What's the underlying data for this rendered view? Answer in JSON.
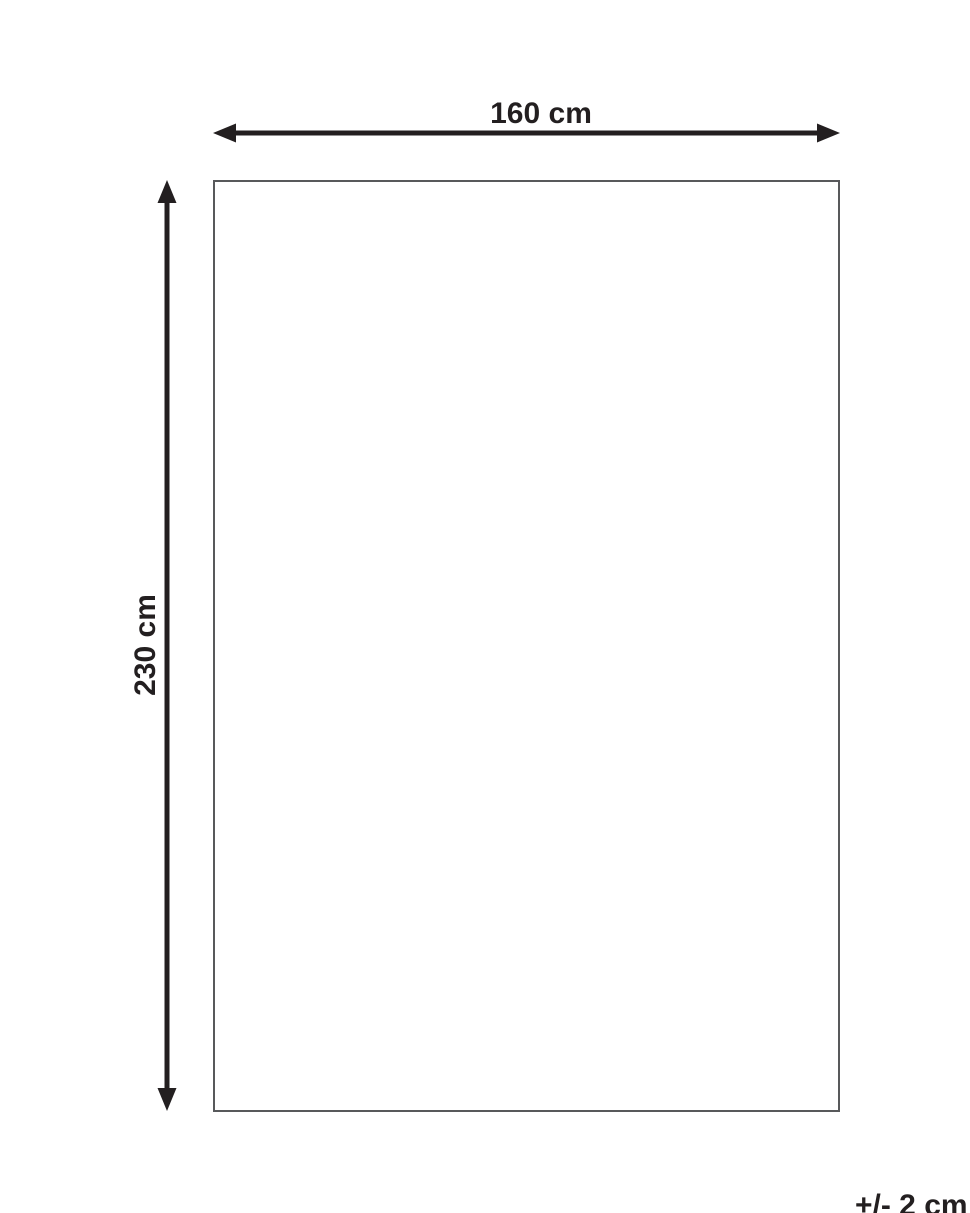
{
  "diagram": {
    "type": "product-dimension-diagram",
    "width_label": "160 cm",
    "height_label": "230 cm",
    "tolerance_label": "+/- 2 cm"
  },
  "colors": {
    "arrow_and_text": "#231f20",
    "rectangle_border": "#58595b",
    "background": "#ffffff"
  }
}
